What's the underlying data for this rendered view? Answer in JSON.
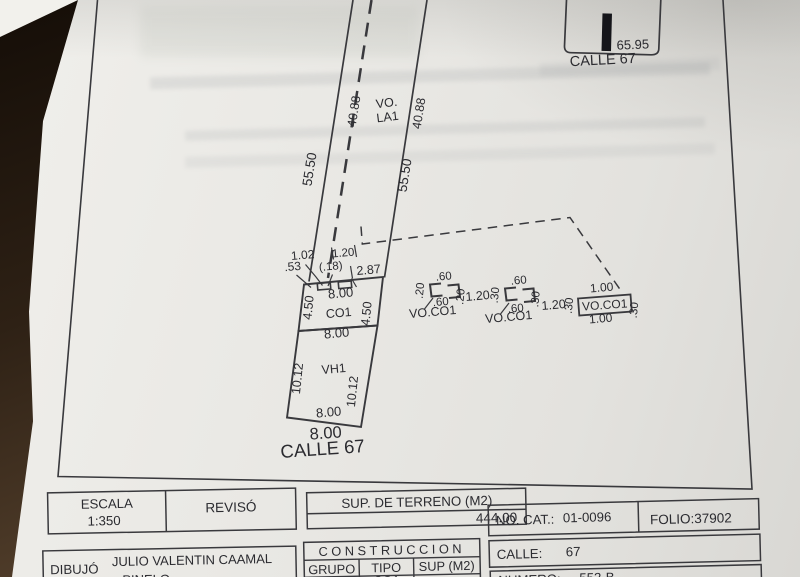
{
  "key_plan": {
    "dimension": "65.95",
    "street": "CALLE 67"
  },
  "plan": {
    "left_side": "55.50",
    "right_side": "55.50",
    "dashed_left": "40.88",
    "dashed_right": "40.88",
    "vo_line1": "VO.",
    "vo_line2": "LA1",
    "front_dims": {
      "a": "1.02",
      "b": ".53",
      "c": "1.20",
      "d": "(.18)",
      "e": "2.87"
    },
    "co1": {
      "name": "CO1",
      "width_top": "8.00",
      "side_left": "4.50",
      "side_right": "4.50"
    },
    "vh1": {
      "name": "VH1",
      "width_top": "8.00",
      "side_left": "10.12",
      "side_right": "10.12",
      "width_bottom": "8.00"
    },
    "lot_front": "8.00",
    "street": "CALLE 67",
    "win1": {
      "top": ".60",
      "left": ".20",
      "right": ".20",
      "bottom": ".60",
      "label": "VO.CO1"
    },
    "gap1": "1.20",
    "win2": {
      "top": ".60",
      "left": ".30",
      "right": ".30",
      "bottom": ".60",
      "label": "VO.CO1"
    },
    "gap2": "1.20",
    "win3": {
      "top": "1.00",
      "left": ".30",
      "right": ".30",
      "bottom": "1.00",
      "label": "VO.CO1"
    }
  },
  "title_block": {
    "escala_label": "ESCALA",
    "escala_value": "1:350",
    "reviso_label": "REVISÓ",
    "dibujo_label": "DIBUJÓ",
    "dibujo_name_line1": "JULIO VALENTIN CAAMAL",
    "dibujo_name_line2": "PINELO",
    "sup_terreno_label": "SUP. DE TERRENO (M2)",
    "sup_terreno_value": "444.00",
    "construccion_label": "CONSTRUCCION",
    "col_grupo": "GRUPO",
    "col_tipo": "TIPO",
    "col_sup": "SUP (M2)",
    "row1_tipo": "CO1",
    "no_cat_label": "NO. CAT.:",
    "no_cat_value": "01-0096",
    "folio": "FOLIO:37902",
    "calle_label": "CALLE:",
    "calle_value": "67",
    "numero_label": "NUMERO:",
    "numero_value": "552-B"
  }
}
